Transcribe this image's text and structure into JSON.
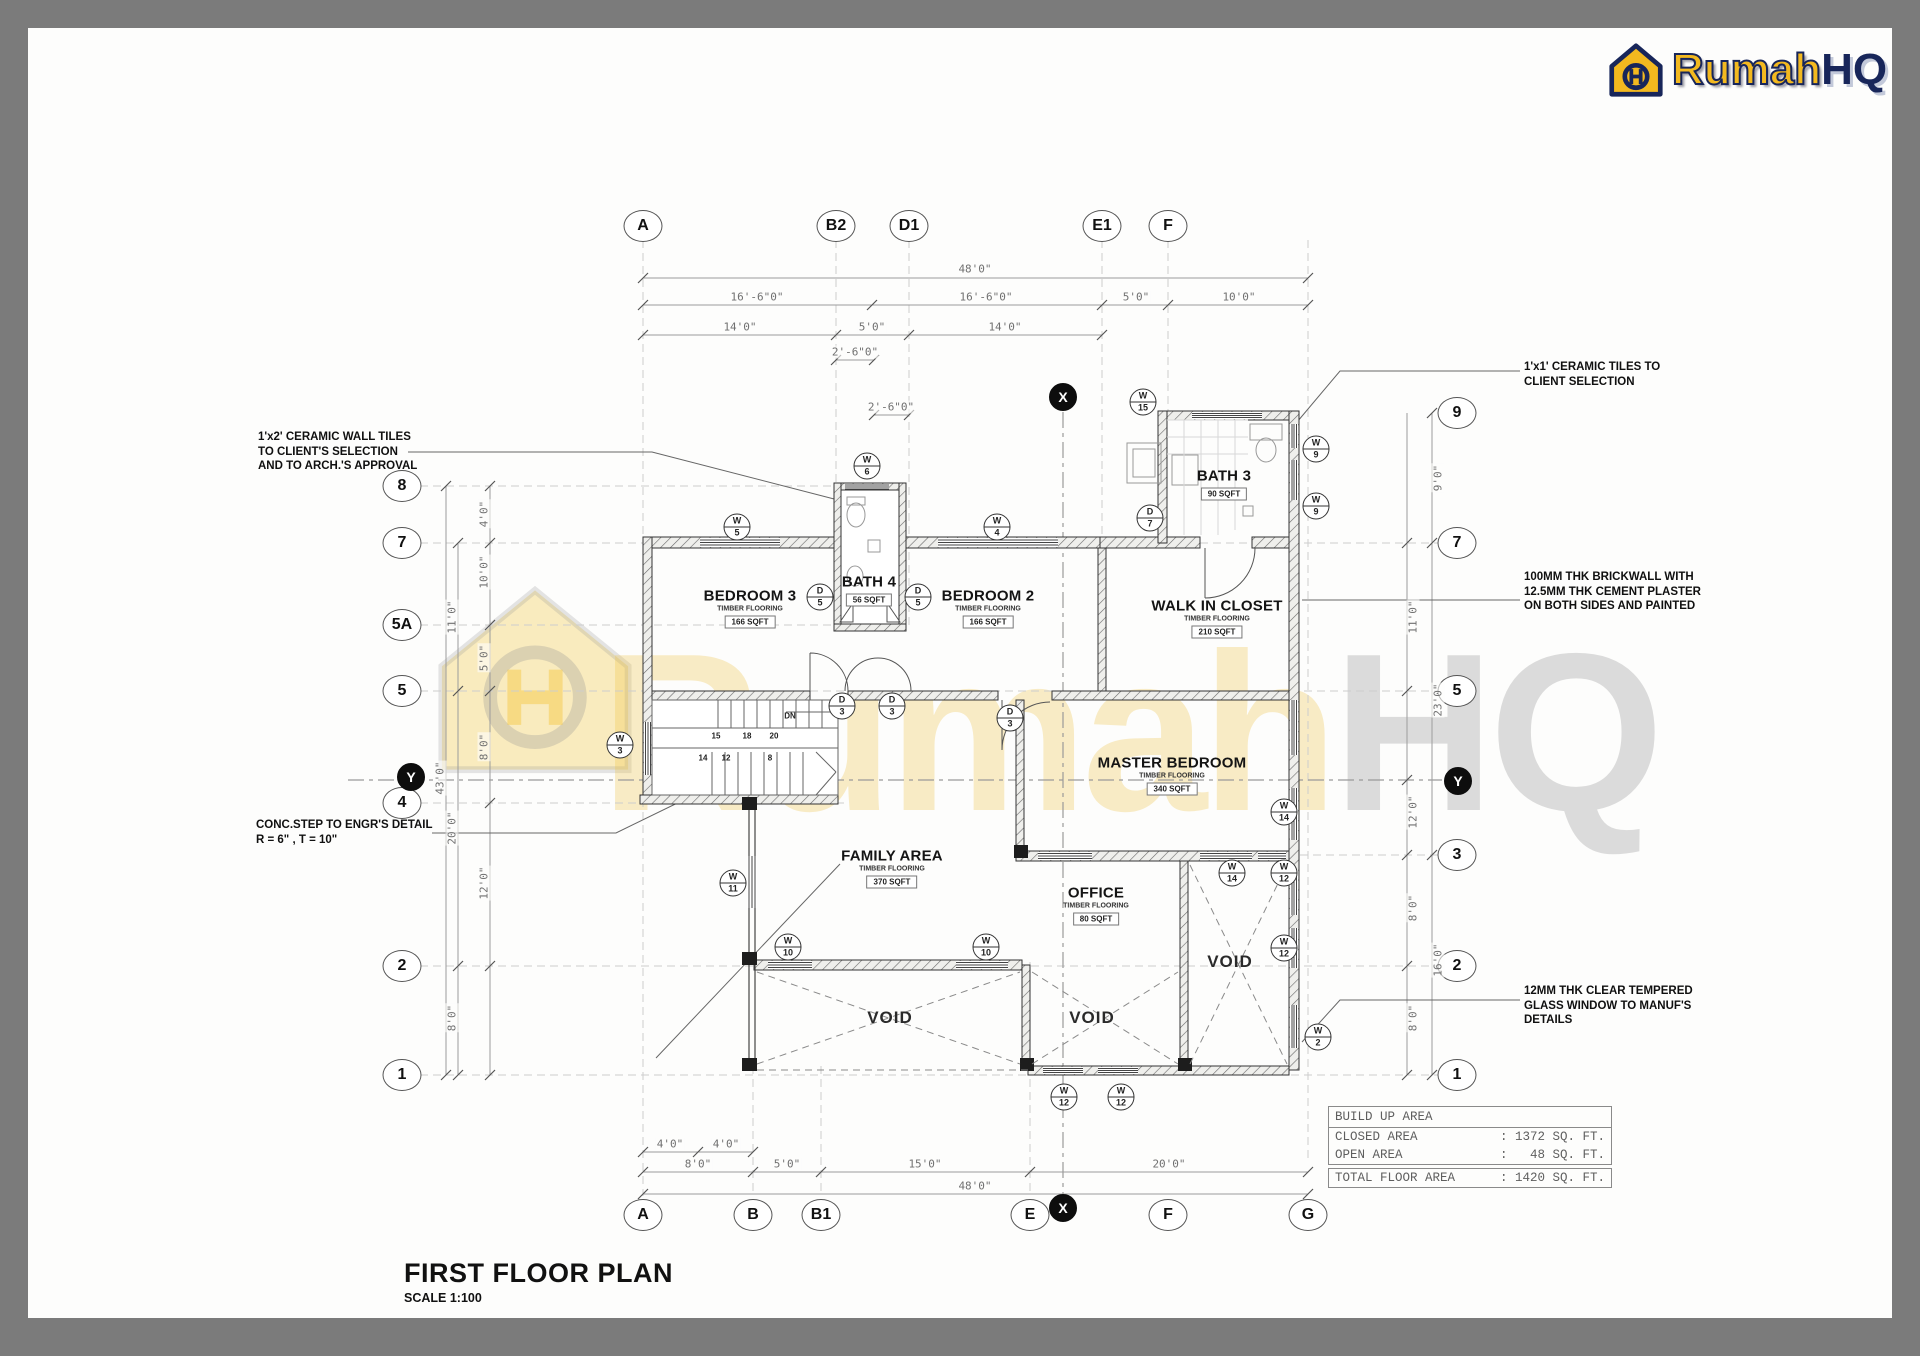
{
  "logo": {
    "brand_1": "Rumah",
    "brand_2": "HQ",
    "color_yellow": "#f3b91f",
    "color_navy": "#18265a"
  },
  "title_block": {
    "title": "FIRST FLOOR PLAN",
    "scale": "SCALE 1:100"
  },
  "watermark": {
    "text_1": "Rumah",
    "text_2": "HQ"
  },
  "table": {
    "header": "BUILD UP AREA",
    "separator": ":",
    "rows": [
      {
        "label": "CLOSED AREA",
        "value": ": 1372 SQ. FT."
      },
      {
        "label": "OPEN AREA",
        "value": ":   48 SQ. FT."
      }
    ],
    "total": {
      "label": "TOTAL FLOOR AREA",
      "value": ": 1420 SQ. FT."
    }
  },
  "annotations": [
    {
      "x": 258,
      "y": 430,
      "lines": [
        "1'x2' CERAMIC WALL TILES",
        "TO CLIENT'S SELECTION",
        "AND TO ARCH.'S APPROVAL"
      ]
    },
    {
      "x": 256,
      "y": 818,
      "lines": [
        "CONC.STEP TO ENGR'S DETAIL",
        "R = 6\" , T = 10\""
      ]
    },
    {
      "x": 1524,
      "y": 360,
      "lines": [
        "1'x1' CERAMIC TILES TO",
        "CLIENT SELECTION"
      ]
    },
    {
      "x": 1524,
      "y": 570,
      "lines": [
        "100MM THK BRICKWALL WITH",
        "12.5MM THK CEMENT PLASTER",
        "ON BOTH SIDES AND PAINTED"
      ]
    },
    {
      "x": 1524,
      "y": 984,
      "lines": [
        "12MM THK CLEAR TEMPERED",
        "GLASS WINDOW TO MANUF'S",
        "DETAILS"
      ]
    }
  ],
  "rooms": [
    {
      "name": "BEDROOM 3",
      "flooring": "TIMBER FLOORING",
      "area": "166 SQFT",
      "x": 750,
      "y": 608
    },
    {
      "name": "BATH 4",
      "flooring": "",
      "area": "56 SQFT",
      "x": 869,
      "y": 590
    },
    {
      "name": "BEDROOM 2",
      "flooring": "TIMBER FLOORING",
      "area": "166 SQFT",
      "x": 988,
      "y": 608
    },
    {
      "name": "BATH 3",
      "flooring": "",
      "area": "90 SQFT",
      "x": 1224,
      "y": 484
    },
    {
      "name": "WALK IN CLOSET",
      "flooring": "TIMBER FLOORING",
      "area": "210 SQFT",
      "x": 1217,
      "y": 618
    },
    {
      "name": "MASTER BEDROOM",
      "flooring": "TIMBER FLOORING",
      "area": "340 SQFT",
      "x": 1172,
      "y": 775
    },
    {
      "name": "FAMILY AREA",
      "flooring": "TIMBER FLOORING",
      "area": "370 SQFT",
      "x": 892,
      "y": 868
    },
    {
      "name": "OFFICE",
      "flooring": "TIMBER FLOORING",
      "area": "80 SQFT",
      "x": 1096,
      "y": 905
    }
  ],
  "voids": [
    {
      "label": "VOID",
      "x": 890,
      "y": 1018
    },
    {
      "label": "VOID",
      "x": 1092,
      "y": 1018
    },
    {
      "label": "VOID",
      "x": 1230,
      "y": 962
    }
  ],
  "grid_bubbles": [
    {
      "label": "A",
      "x": 643,
      "y": 226
    },
    {
      "label": "B2",
      "x": 836,
      "y": 226
    },
    {
      "label": "D1",
      "x": 909,
      "y": 226
    },
    {
      "label": "E1",
      "x": 1102,
      "y": 226
    },
    {
      "label": "F",
      "x": 1168,
      "y": 226
    },
    {
      "label": "A",
      "x": 643,
      "y": 1215
    },
    {
      "label": "B",
      "x": 753,
      "y": 1215
    },
    {
      "label": "B1",
      "x": 821,
      "y": 1215
    },
    {
      "label": "E",
      "x": 1030,
      "y": 1215
    },
    {
      "label": "F",
      "x": 1168,
      "y": 1215
    },
    {
      "label": "G",
      "x": 1308,
      "y": 1215
    },
    {
      "label": "8",
      "x": 402,
      "y": 486
    },
    {
      "label": "7",
      "x": 402,
      "y": 543
    },
    {
      "label": "5A",
      "x": 402,
      "y": 625
    },
    {
      "label": "5",
      "x": 402,
      "y": 691
    },
    {
      "label": "4",
      "x": 402,
      "y": 803
    },
    {
      "label": "2",
      "x": 402,
      "y": 966
    },
    {
      "label": "1",
      "x": 402,
      "y": 1075
    },
    {
      "label": "9",
      "x": 1457,
      "y": 413
    },
    {
      "label": "7",
      "x": 1457,
      "y": 543
    },
    {
      "label": "5",
      "x": 1457,
      "y": 691
    },
    {
      "label": "3",
      "x": 1457,
      "y": 855
    },
    {
      "label": "2",
      "x": 1457,
      "y": 966
    },
    {
      "label": "1",
      "x": 1457,
      "y": 1075
    }
  ],
  "section_markers": [
    {
      "label": "X",
      "x": 1063,
      "y": 397
    },
    {
      "label": "X",
      "x": 1063,
      "y": 1208
    },
    {
      "label": "Y",
      "x": 411,
      "y": 777
    },
    {
      "label": "Y",
      "x": 1458,
      "y": 781
    }
  ],
  "tags": [
    {
      "top": "W",
      "bottom": "5",
      "x": 737,
      "y": 527
    },
    {
      "top": "W",
      "bottom": "6",
      "x": 867,
      "y": 466
    },
    {
      "top": "W",
      "bottom": "4",
      "x": 997,
      "y": 527
    },
    {
      "top": "W",
      "bottom": "15",
      "x": 1143,
      "y": 402
    },
    {
      "top": "W",
      "bottom": "9",
      "x": 1316,
      "y": 449
    },
    {
      "top": "W",
      "bottom": "9",
      "x": 1316,
      "y": 506
    },
    {
      "top": "W",
      "bottom": "3",
      "x": 620,
      "y": 745
    },
    {
      "top": "W",
      "bottom": "14",
      "x": 1284,
      "y": 812
    },
    {
      "top": "W",
      "bottom": "14",
      "x": 1232,
      "y": 873
    },
    {
      "top": "W",
      "bottom": "12",
      "x": 1284,
      "y": 873
    },
    {
      "top": "W",
      "bottom": "12",
      "x": 1284,
      "y": 948
    },
    {
      "top": "W",
      "bottom": "2",
      "x": 1318,
      "y": 1037
    },
    {
      "top": "W",
      "bottom": "11",
      "x": 733,
      "y": 883
    },
    {
      "top": "W",
      "bottom": "10",
      "x": 788,
      "y": 947
    },
    {
      "top": "W",
      "bottom": "10",
      "x": 986,
      "y": 947
    },
    {
      "top": "W",
      "bottom": "12",
      "x": 1064,
      "y": 1097
    },
    {
      "top": "W",
      "bottom": "12",
      "x": 1121,
      "y": 1097
    },
    {
      "top": "D",
      "bottom": "5",
      "x": 820,
      "y": 597
    },
    {
      "top": "D",
      "bottom": "5",
      "x": 918,
      "y": 597
    },
    {
      "top": "D",
      "bottom": "7",
      "x": 1150,
      "y": 518
    },
    {
      "top": "D",
      "bottom": "3",
      "x": 842,
      "y": 706
    },
    {
      "top": "D",
      "bottom": "3",
      "x": 892,
      "y": 706
    },
    {
      "top": "D",
      "bottom": "3",
      "x": 1010,
      "y": 718
    }
  ],
  "dims": [
    {
      "label": "48'0\"",
      "x": 975,
      "y": 269,
      "rot": false
    },
    {
      "label": "16'-6\"0\"",
      "x": 757,
      "y": 297,
      "rot": false
    },
    {
      "label": "16'-6\"0\"",
      "x": 986,
      "y": 297,
      "rot": false
    },
    {
      "label": "5'0\"",
      "x": 1136,
      "y": 297,
      "rot": false
    },
    {
      "label": "10'0\"",
      "x": 1239,
      "y": 297,
      "rot": false
    },
    {
      "label": "14'0\"",
      "x": 740,
      "y": 327,
      "rot": false
    },
    {
      "label": "5'0\"",
      "x": 872,
      "y": 327,
      "rot": false
    },
    {
      "label": "14'0\"",
      "x": 1005,
      "y": 327,
      "rot": false
    },
    {
      "label": "2'-6\"0\"",
      "x": 855,
      "y": 352,
      "rot": false
    },
    {
      "label": "2'-6\"0\"",
      "x": 891,
      "y": 407,
      "rot": false
    },
    {
      "label": "4'0\"",
      "x": 670,
      "y": 1144,
      "rot": false
    },
    {
      "label": "4'0\"",
      "x": 726,
      "y": 1144,
      "rot": false
    },
    {
      "label": "8'0\"",
      "x": 698,
      "y": 1164,
      "rot": false
    },
    {
      "label": "5'0\"",
      "x": 787,
      "y": 1164,
      "rot": false
    },
    {
      "label": "15'0\"",
      "x": 925,
      "y": 1164,
      "rot": false
    },
    {
      "label": "20'0\"",
      "x": 1169,
      "y": 1164,
      "rot": false
    },
    {
      "label": "48'0\"",
      "x": 975,
      "y": 1186,
      "rot": false
    },
    {
      "label": "4'0\"",
      "x": 484,
      "y": 514,
      "rot": true
    },
    {
      "label": "10'0\"",
      "x": 484,
      "y": 572,
      "rot": true
    },
    {
      "label": "5'0\"",
      "x": 484,
      "y": 658,
      "rot": true
    },
    {
      "label": "8'0\"",
      "x": 484,
      "y": 747,
      "rot": true
    },
    {
      "label": "12'0\"",
      "x": 484,
      "y": 883,
      "rot": true
    },
    {
      "label": "11'0\"",
      "x": 452,
      "y": 617,
      "rot": true
    },
    {
      "label": "20'0\"",
      "x": 452,
      "y": 828,
      "rot": true
    },
    {
      "label": "8'0\"",
      "x": 452,
      "y": 1018,
      "rot": true
    },
    {
      "label": "43'0\"",
      "x": 440,
      "y": 778,
      "rot": true
    },
    {
      "label": "9'0\"",
      "x": 1438,
      "y": 478,
      "rot": true
    },
    {
      "label": "23'0\"",
      "x": 1438,
      "y": 700,
      "rot": true
    },
    {
      "label": "16'0\"",
      "x": 1438,
      "y": 960,
      "rot": true
    },
    {
      "label": "11'0\"",
      "x": 1413,
      "y": 617,
      "rot": true
    },
    {
      "label": "12'0\"",
      "x": 1413,
      "y": 812,
      "rot": true
    },
    {
      "label": "8'0\"",
      "x": 1413,
      "y": 908,
      "rot": true
    },
    {
      "label": "8'0\"",
      "x": 1413,
      "y": 1018,
      "rot": true
    }
  ],
  "stairs": {
    "labels": [
      {
        "text": "15",
        "x": 716,
        "y": 736
      },
      {
        "text": "18",
        "x": 747,
        "y": 736
      },
      {
        "text": "20",
        "x": 774,
        "y": 736
      },
      {
        "text": "14",
        "x": 703,
        "y": 758
      },
      {
        "text": "12",
        "x": 726,
        "y": 758
      },
      {
        "text": "8",
        "x": 770,
        "y": 758
      },
      {
        "text": "DN",
        "x": 790,
        "y": 716
      }
    ]
  }
}
